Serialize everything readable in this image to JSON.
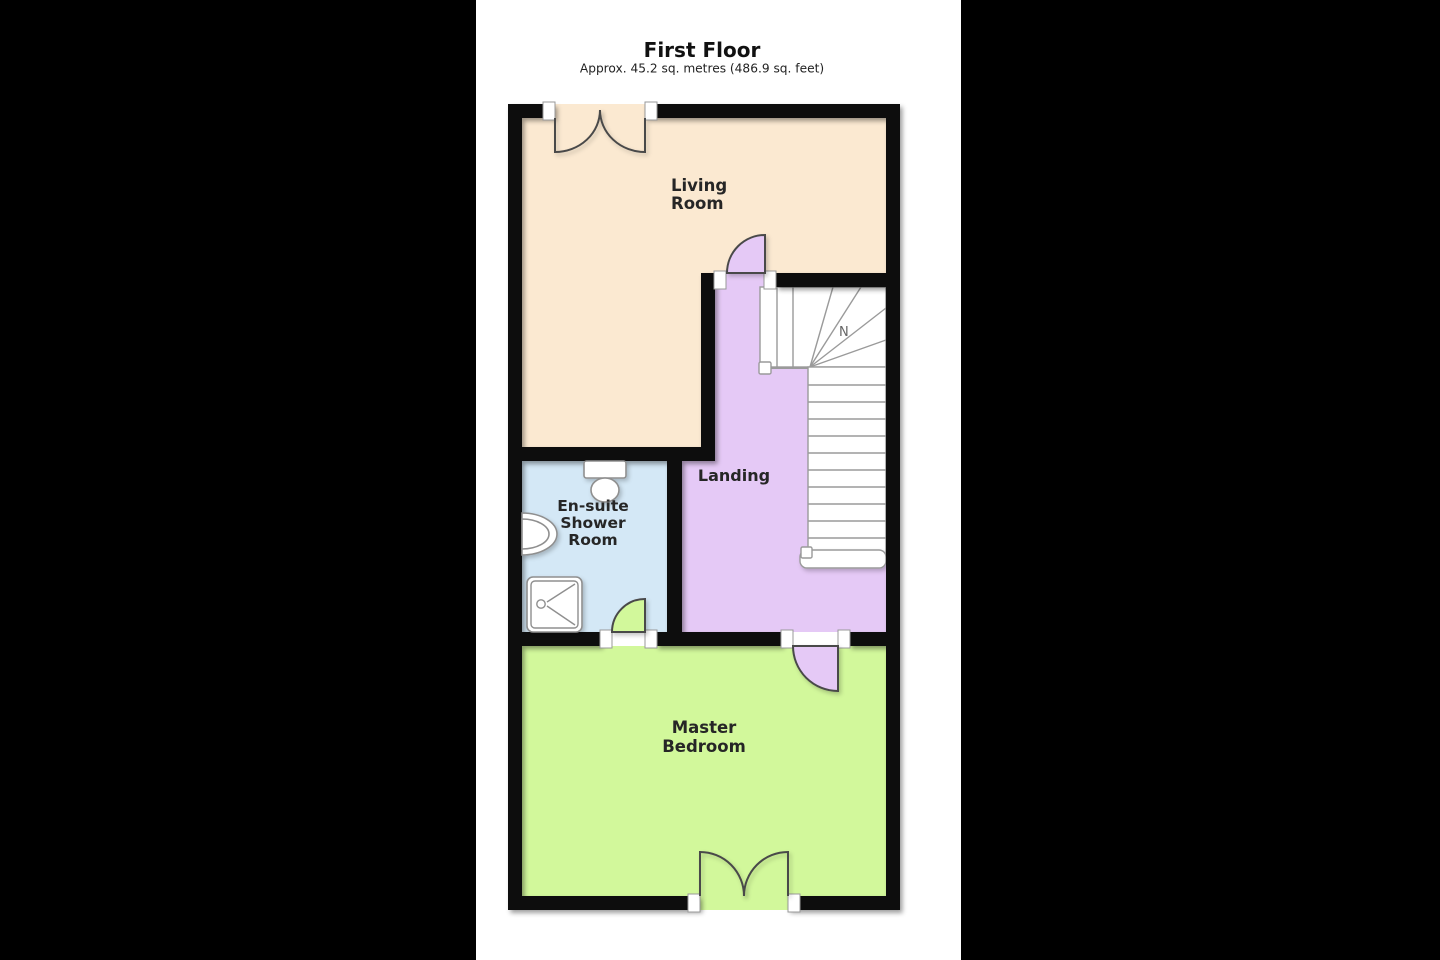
{
  "page": {
    "letterbox_color": "#000000",
    "canvas_color": "#ffffff"
  },
  "header": {
    "title": "First Floor",
    "subtitle": "Approx. 45.2 sq. metres (486.9 sq. feet)"
  },
  "floorplan": {
    "wall_color": "#0d0d0d",
    "rooms": {
      "living": {
        "name": "Living Room",
        "lines": [
          "Living",
          "Room"
        ],
        "color": "#fbe9d1"
      },
      "landing": {
        "name": "Landing",
        "lines": [
          "Landing"
        ],
        "color": "#e5c9f6"
      },
      "ensuite": {
        "name": "En-suite Shower Room",
        "lines": [
          "En-suite",
          "Shower",
          "Room"
        ],
        "color": "#d4e8f6"
      },
      "master": {
        "name": "Master Bedroom",
        "lines": [
          "Master",
          "Bedroom"
        ],
        "color": "#d2f89b"
      }
    },
    "stairs": {
      "winder_mark": "N"
    },
    "fixtures": {
      "toilet": "toilet",
      "sink": "wash-basin",
      "shower": "shower-tray"
    }
  }
}
